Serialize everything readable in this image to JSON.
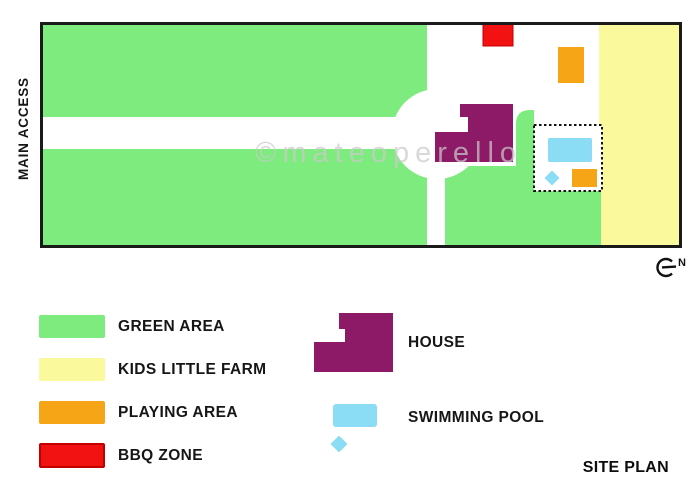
{
  "map": {
    "main_access_label": "MAIN ACCESS",
    "watermark": "©mateoperello",
    "north_label": "N"
  },
  "colors": {
    "green": "#7DEB7D",
    "yellow": "#FAF99C",
    "orange": "#F5A515",
    "red": "#F31212",
    "red_border": "#C00000",
    "purple": "#8C1A66",
    "pool": "#8BDCF5",
    "watermark_gray": "#CBCBCB",
    "border_black": "#1A1A1A"
  },
  "legend": {
    "items": [
      {
        "label": "GREEN AREA"
      },
      {
        "label": "KIDS LITTLE FARM"
      },
      {
        "label": "PLAYING AREA"
      },
      {
        "label": "BBQ ZONE"
      }
    ],
    "house_label": "HOUSE",
    "pool_label": "SWIMMING POOL"
  },
  "footer": {
    "title": "SITE PLAN"
  }
}
